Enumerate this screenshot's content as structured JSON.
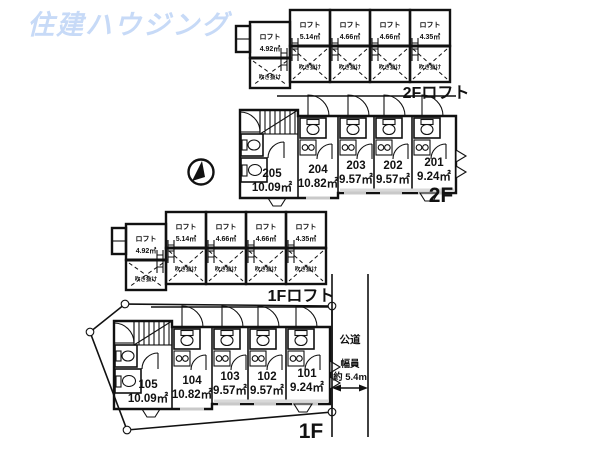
{
  "colors": {
    "background": "#ffffff",
    "line": "#111111",
    "logo": "#c7daf7"
  },
  "logo": {
    "text": "住建ハウジング"
  },
  "floors": {
    "loft2f": {
      "label": "2Fロフト",
      "units": [
        {
          "name": "ロフト",
          "area": "4.92㎡",
          "void": "吹き抜け"
        },
        {
          "name": "ロフト",
          "area": "5.14㎡",
          "void": "吹き抜け"
        },
        {
          "name": "ロフト",
          "area": "4.66㎡",
          "void": "吹き抜け"
        },
        {
          "name": "ロフト",
          "area": "4.66㎡",
          "void": "吹き抜け"
        },
        {
          "name": "ロフト",
          "area": "4.35㎡",
          "void": "吹き抜け"
        }
      ]
    },
    "f2": {
      "label": "2F",
      "rooms": [
        {
          "no": "205",
          "area": "10.09㎡"
        },
        {
          "no": "204",
          "area": "10.82㎡"
        },
        {
          "no": "203",
          "area": "9.57㎡"
        },
        {
          "no": "202",
          "area": "9.57㎡"
        },
        {
          "no": "201",
          "area": "9.24㎡"
        }
      ]
    },
    "loft1f": {
      "label": "1Fロフト",
      "units": [
        {
          "name": "ロフト",
          "area": "4.92㎡",
          "void": "吹き抜け"
        },
        {
          "name": "ロフト",
          "area": "5.14㎡",
          "void": "吹き抜け"
        },
        {
          "name": "ロフト",
          "area": "4.66㎡",
          "void": "吹き抜け"
        },
        {
          "name": "ロフト",
          "area": "4.66㎡",
          "void": "吹き抜け"
        },
        {
          "name": "ロフト",
          "area": "4.35㎡",
          "void": "吹き抜け"
        }
      ]
    },
    "f1": {
      "label": "1F",
      "rooms": [
        {
          "no": "105",
          "area": "10.09㎡"
        },
        {
          "no": "104",
          "area": "10.82㎡"
        },
        {
          "no": "103",
          "area": "9.57㎡"
        },
        {
          "no": "102",
          "area": "9.57㎡"
        },
        {
          "no": "101",
          "area": "9.24㎡"
        }
      ]
    }
  },
  "road": {
    "name": "公道",
    "width_label": "幅員",
    "width_value": "約 5.4m"
  },
  "icons": {
    "compass": "north-arrow"
  }
}
